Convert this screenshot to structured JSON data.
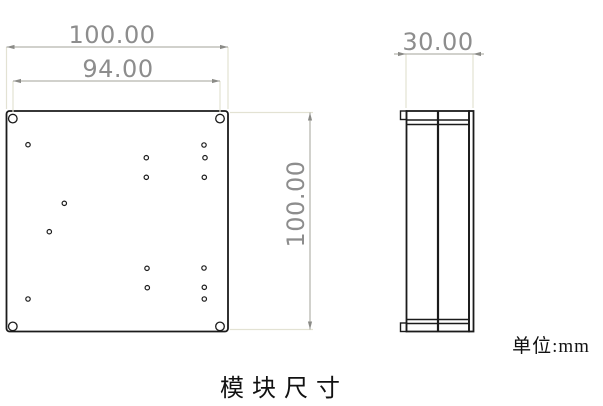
{
  "drawing": {
    "caption": "模块尺寸",
    "units_label": "单位:mm",
    "dimensions": {
      "front_width_label": "100.00",
      "hole_spacing_label": "94.00",
      "front_height_label": "100.00",
      "side_depth_label": "30.00"
    },
    "front_view": {
      "plate": {
        "x": 6.5,
        "y": 111,
        "width": 221.5,
        "height": 220.5,
        "corner_radius": 3
      },
      "corner_holes": {
        "radius": 4.3,
        "centers": [
          [
            12.8,
            118.6
          ],
          [
            220.0,
            118.6
          ],
          [
            12.8,
            326.4
          ],
          [
            220.0,
            326.4
          ]
        ]
      },
      "small_holes": {
        "radius": 2.2,
        "centers": [
          [
            28.0,
            144.7
          ],
          [
            204.0,
            145.0
          ],
          [
            146.3,
            157.7
          ],
          [
            205.0,
            157.7
          ],
          [
            146.3,
            177.3
          ],
          [
            204.3,
            177.3
          ],
          [
            64.3,
            203.3
          ],
          [
            49.3,
            231.7
          ],
          [
            147.0,
            268.3
          ],
          [
            204.0,
            268.0
          ],
          [
            147.3,
            287.7
          ],
          [
            204.3,
            287.3
          ],
          [
            28.0,
            299.0
          ],
          [
            204.3,
            299.0
          ]
        ]
      }
    },
    "side_view": {
      "body": {
        "x": 406.5,
        "y": 111,
        "width": 62.5,
        "height": 220.5
      },
      "front_plate_edge": {
        "x": 469,
        "y": 111,
        "width": 4.5,
        "height": 220.5
      },
      "top_left_step": {
        "x": 400.5,
        "y": 111,
        "width": 6,
        "height": 8.5
      },
      "bottom_left_step": {
        "x": 400.5,
        "y": 323,
        "width": 6,
        "height": 8.5
      }
    },
    "colors": {
      "outline": "#1b1b1b",
      "dimension_line": "#a3a39a",
      "extension_line": "#e3e2d3",
      "dimension_text": "#8d8d8d",
      "background": "#ffffff"
    }
  }
}
